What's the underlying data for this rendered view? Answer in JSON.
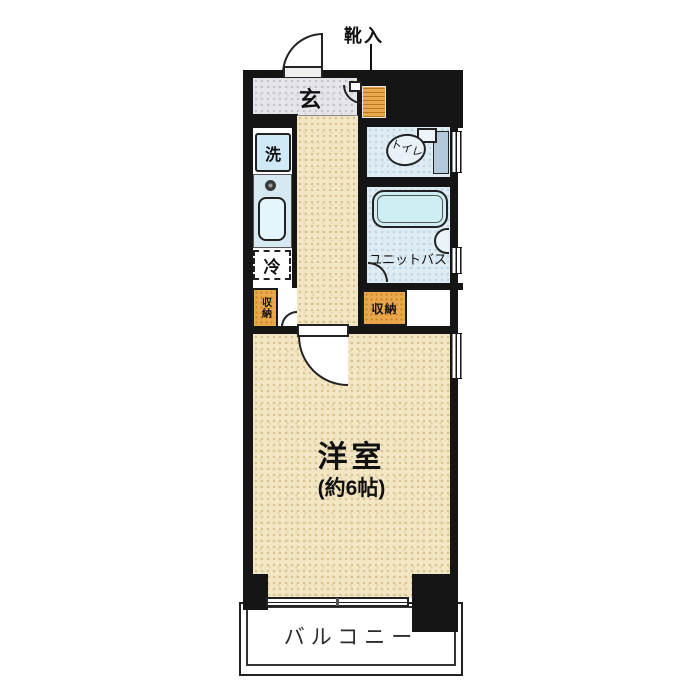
{
  "floorplan": {
    "labels": {
      "shoe_storage": "靴入",
      "entrance": "玄",
      "washer": "洗",
      "refrigerator": "冷",
      "toilet": "トイレ",
      "unit_bath": "ユニットバス",
      "storage_left": "収納",
      "storage_right": "収納",
      "room_name": "洋室",
      "room_size": "(約6帖)",
      "balcony": "バルコニー"
    },
    "colors": {
      "wall": "#151515",
      "floor_beige": "#f2e6c4",
      "entrance_gray": "#e5e5ea",
      "wet_area_blue": "#dfecf4",
      "fixture_fill": "#cdeff3",
      "storage_orange": "#eaa84e",
      "balcony_white": "#ffffff"
    }
  }
}
